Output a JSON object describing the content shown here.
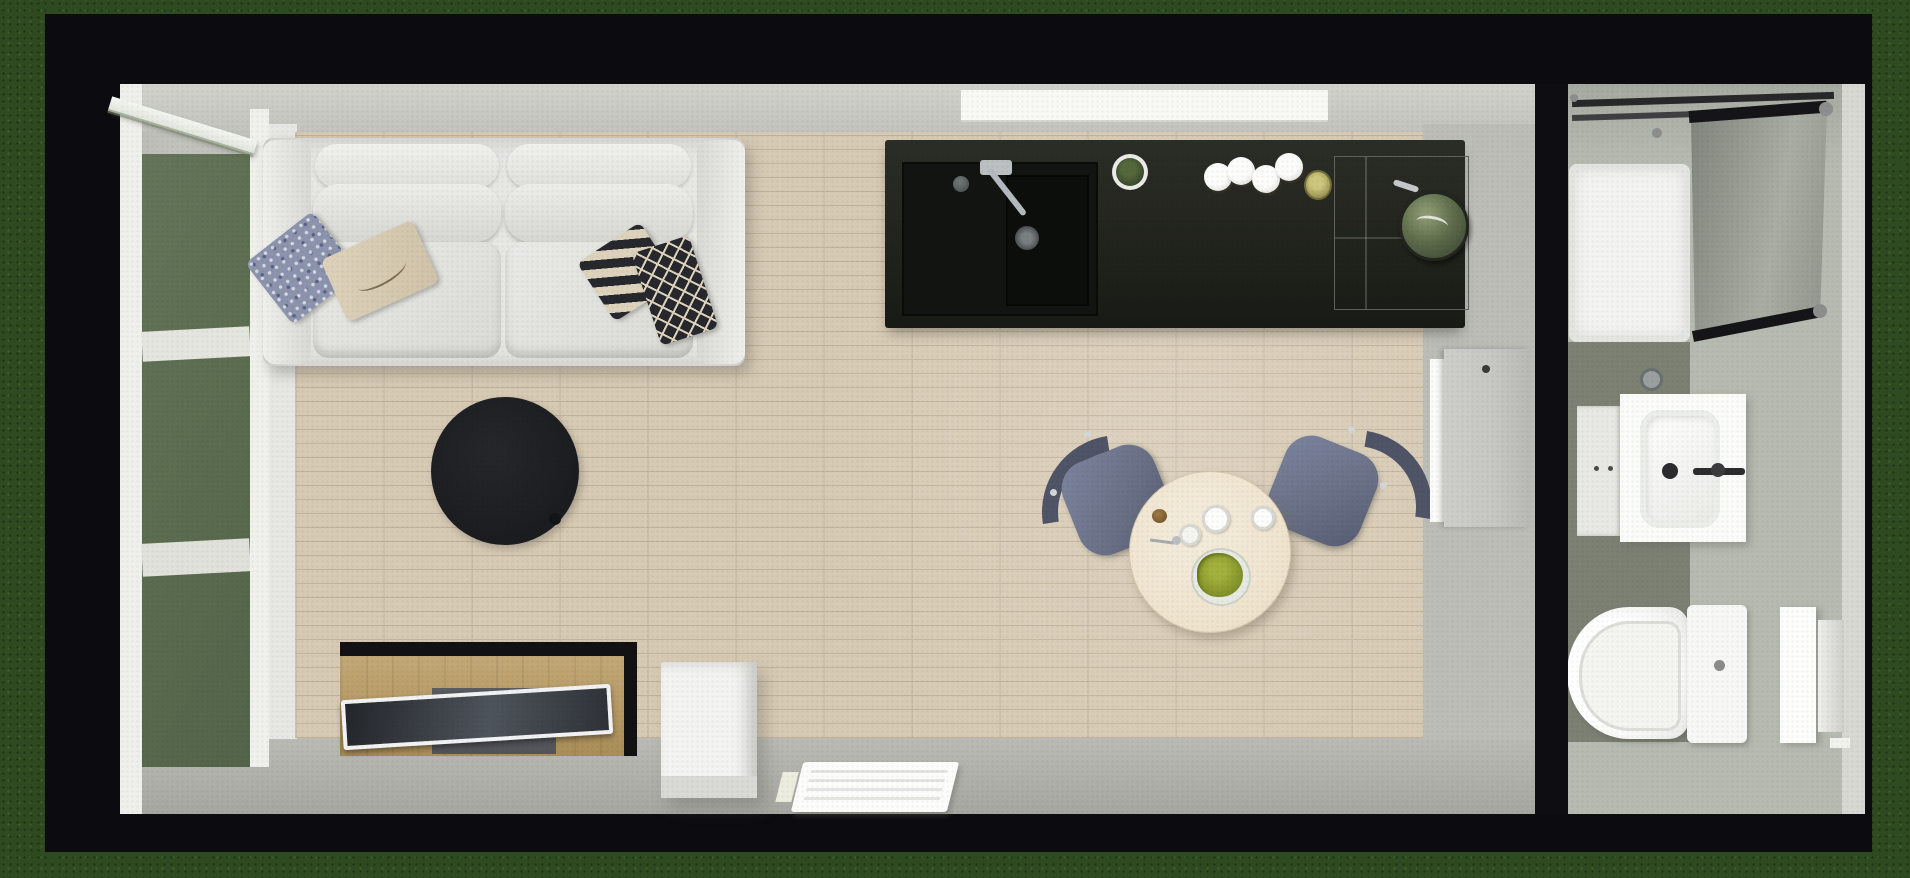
{
  "meta": {
    "view": "top-down 3d floorplan render",
    "setting": "tiny house on grass"
  },
  "palette": {
    "grass": "#2d4a20",
    "wallBlack": "#0c0c10",
    "wallFace": "#d2d2cd",
    "wallFaceDark": "#c2c2bd",
    "floorStrip": "#bdbdb8",
    "thresholdWhite": "#e7e7e3",
    "frameWhite": "#efefec",
    "glassGreen": "#5c6d50",
    "woodBase": "#d7cab4",
    "woodSeam": "#c2b29a",
    "counterTop": "#24261f",
    "sinkBlack": "#121411",
    "steel": "#bcc0c3",
    "panGreen": "#5e6d4b",
    "sofaBase": "#e7e7e4",
    "sofaShade": "#d8d8d4",
    "pillowBlue": "#8b93ad",
    "pillowBeige": "#d8ccb3",
    "pillowInk": "#26282d",
    "pillowCream": "#ddd3bc",
    "rugBlack": "#1b1c1f",
    "tvWood": "#b8995f",
    "tvRecess": "#53555a",
    "tvFrame": "#f0f2f3",
    "whiteGoods": "#f3f3f1",
    "heaterWhite": "#fcfcfa",
    "tableCream": "#eee3cd",
    "chairSeat": "#6a7186",
    "chairBack": "#4f5466",
    "saladGreen": "#8b9a2e",
    "bathFloor": "#b6bab0",
    "bathFloorDark": "#7d8174",
    "trayWhite": "#f3f3f1",
    "frameInk": "#151518",
    "porcelain": "#f7f7f5",
    "doorLeaf": "#c6c6c2"
  },
  "inventory": {
    "living_area": [
      "sofa-white-two-seater",
      "pillow-blue-pattern",
      "pillow-beige-script",
      "pillow-striped",
      "pillow-black-diamond",
      "round-black-rug",
      "tv-stand-wood",
      "tv-flatscreen",
      "white-cabinet",
      "wall-heater",
      "glazed-green-door-left",
      "open-door-leaf"
    ],
    "kitchen": [
      "black-counter",
      "sink-black",
      "faucet",
      "plant-pot",
      "plates-stack",
      "small-bowl",
      "cooktop",
      "green-pan",
      "window-top"
    ],
    "dining": [
      "round-table-cream",
      "chair-left-blue",
      "chair-right-blue",
      "salad-plate",
      "cups",
      "spoon"
    ],
    "bathroom": [
      "shower-tray",
      "shower-glass-panel",
      "vanity-sink",
      "side-cabinet",
      "toilet",
      "door-right",
      "door-to-bathroom"
    ]
  }
}
